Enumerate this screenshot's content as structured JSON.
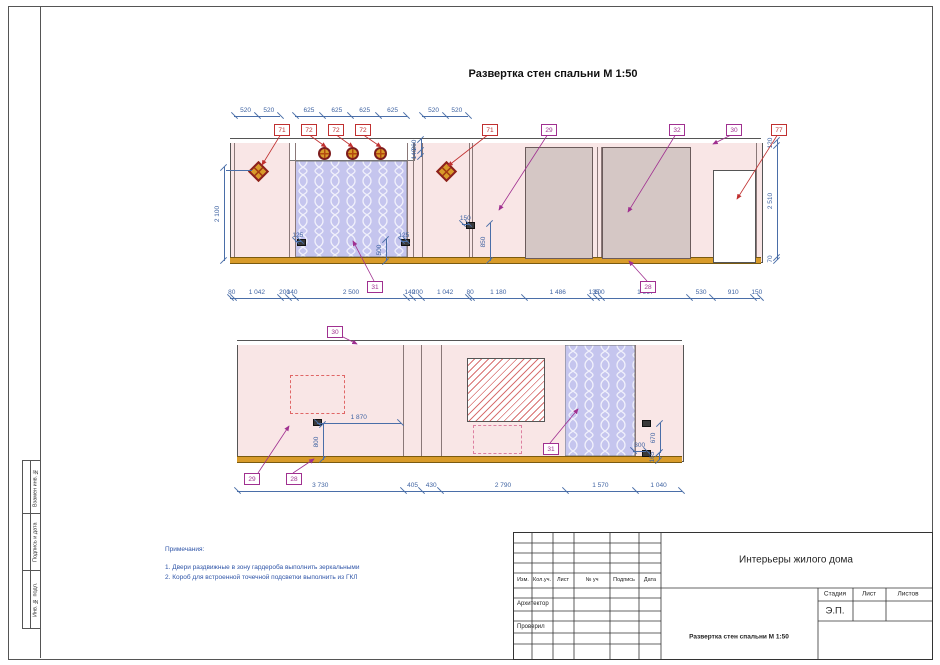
{
  "page": {
    "title": "Развертка стен спальни М 1:50",
    "sidebar": [
      "Взамен инв. №",
      "Подпись и дата",
      "Инв. № подл."
    ]
  },
  "callouts": {
    "c71": "71",
    "c72": "72",
    "c77": "77",
    "c28": "28",
    "c29": "29",
    "c30": "30",
    "c31": "31",
    "c32": "32"
  },
  "elev1": {
    "dims_top_left": [
      "520",
      "520"
    ],
    "dims_top_niche": [
      "625",
      "625",
      "625",
      "625"
    ],
    "dims_top_mid": [
      "520",
      "520"
    ],
    "dims_bottom": [
      "80",
      "1 042",
      "200",
      "140",
      "2 500",
      "140",
      "200",
      "1 042",
      "80",
      "1 180",
      "1 486",
      "135",
      "100",
      "1 967",
      "530",
      "910",
      "150"
    ],
    "dims_right": [
      "120",
      "2 510",
      "70"
    ],
    "dim_height": [
      "2 100"
    ],
    "dims_niche": [
      "260",
      "140"
    ],
    "dim_socket1": [
      "125"
    ],
    "dim_socket2": [
      "125"
    ],
    "dim_socket2_h": [
      "500"
    ],
    "dim_socket3": [
      "150"
    ],
    "dim_socket3_h": [
      "850"
    ]
  },
  "elev2": {
    "dims_bottom": [
      "3 730",
      "405",
      "430",
      "2 790",
      "1 570",
      "1 040"
    ],
    "dim_tv": [
      "1 870"
    ],
    "dim_tv_h": [
      "800"
    ],
    "dim_socket": [
      "300"
    ],
    "dim_socket_h": [
      "670"
    ],
    "dim_socket_floor": [
      "165"
    ]
  },
  "notes": {
    "title": "Примечания:",
    "items": [
      "1. Двери раздвижные в зону гардероба выполнить зеркальными",
      "2. Короб для встроенной точечной подсветки выполнить из ГКЛ"
    ]
  },
  "titleblock": {
    "project": "Интерьеры жилого дома",
    "drawing": "Развертка стен спальни М 1:50",
    "cols": [
      "Изм.",
      "Кол.уч.",
      "Лист",
      "№ уч",
      "Подпись",
      "Дата"
    ],
    "architect_label": "Архитектор",
    "checked_label": "Проверил",
    "stage_label": "Стадия",
    "sheet_label": "Лист",
    "sheets_label": "Листов",
    "stage_value": "Э.П."
  }
}
